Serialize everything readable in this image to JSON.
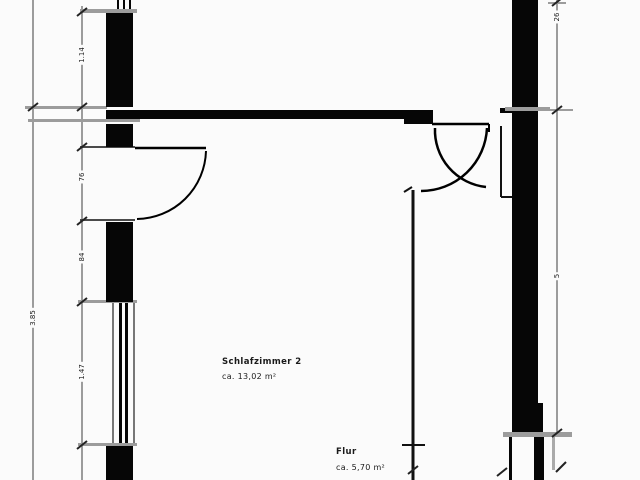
{
  "plan_title": "floor-plan",
  "rooms": [
    {
      "name": "Schlafzimmer 2",
      "area": "ca. 13,02 m²"
    },
    {
      "name": "Flur",
      "area": "ca. 5,70 m²"
    }
  ],
  "dimensions": {
    "outer_left": "3.85",
    "left_top_segment": "1.14",
    "left_door_segment": "76",
    "left_pier_segment": "84",
    "left_window_segment": "1.47",
    "right_top_segment": "26",
    "right_side_segment": "5"
  },
  "icons": {
    "door_swing": "quarter-arc",
    "window": "double-line",
    "dimension_tick": "diagonal-slash"
  },
  "colors": {
    "wall": "#060606",
    "dim_line": "#9c9c9c",
    "thin_line": "#4a4a4a",
    "background": "#fbfbfb",
    "text": "#1a1a1a"
  }
}
